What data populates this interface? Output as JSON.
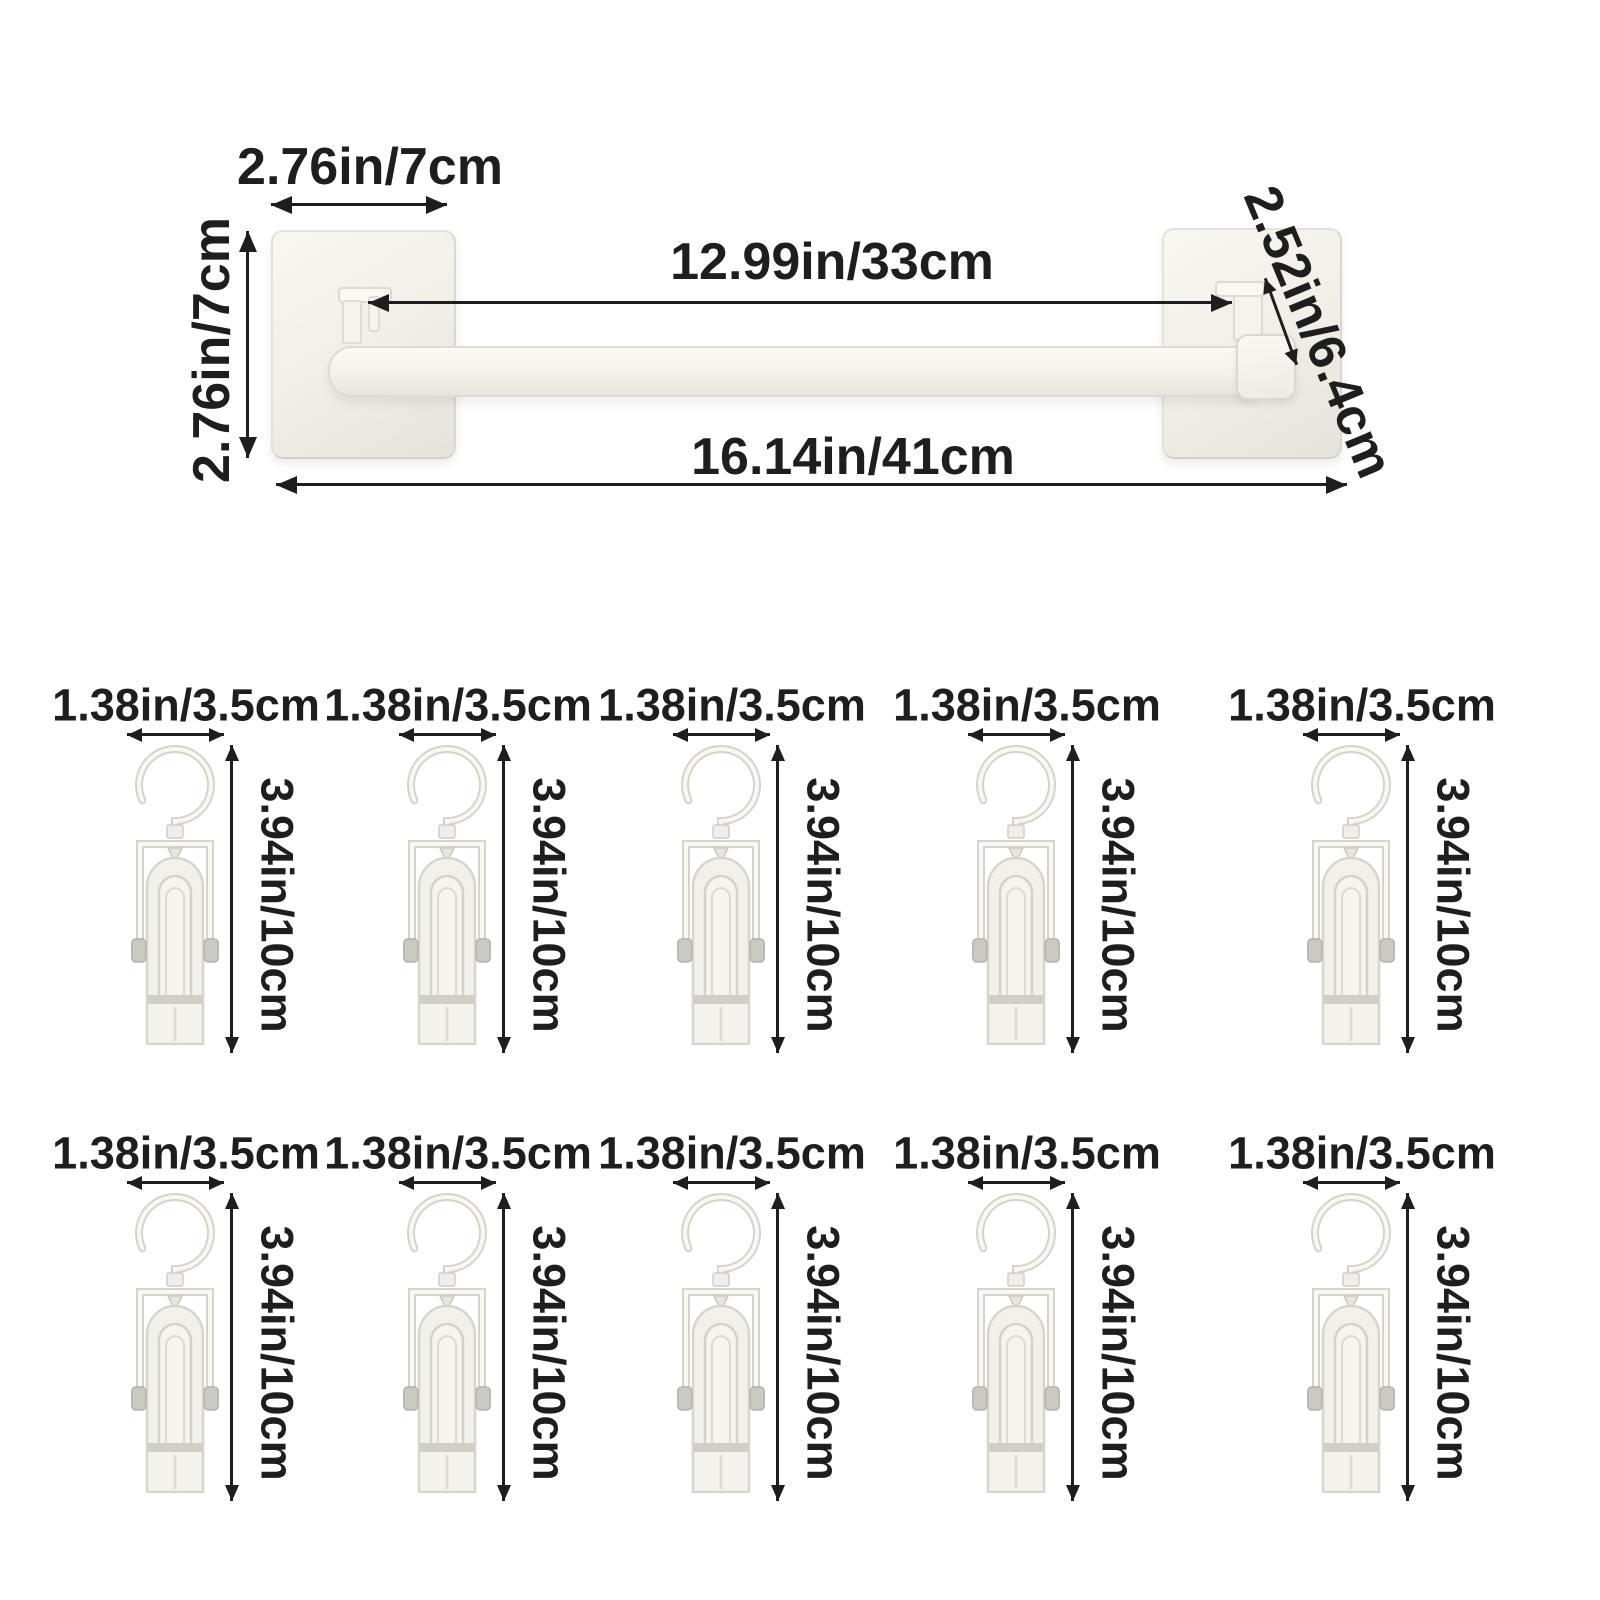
{
  "colors": {
    "ink": "#1e1e1e",
    "product_fill": "#f2f1eb",
    "product_outline": "#d9d8d0",
    "background": "#ffffff"
  },
  "rail": {
    "plate_width_label": "2.76in/7cm",
    "plate_height_label": "2.76in/7cm",
    "inner_span_label": "12.99in/33cm",
    "total_span_label": "16.14in/41cm",
    "hook_depth_label": "2.52in/6.4cm"
  },
  "clips": {
    "rows": [
      {
        "items": [
          {
            "width_label": "1.38in/3.5cm",
            "height_label": "3.94in/10cm"
          },
          {
            "width_label": "1.38in/3.5cm",
            "height_label": "3.94in/10cm"
          },
          {
            "width_label": "1.38in/3.5cm",
            "height_label": "3.94in/10cm"
          },
          {
            "width_label": "1.38in/3.5cm",
            "height_label": "3.94in/10cm"
          },
          {
            "width_label": "1.38in/3.5cm",
            "height_label": "3.94in/10cm"
          }
        ]
      },
      {
        "items": [
          {
            "width_label": "1.38in/3.5cm",
            "height_label": "3.94in/10cm"
          },
          {
            "width_label": "1.38in/3.5cm",
            "height_label": "3.94in/10cm"
          },
          {
            "width_label": "1.38in/3.5cm",
            "height_label": "3.94in/10cm"
          },
          {
            "width_label": "1.38in/3.5cm",
            "height_label": "3.94in/10cm"
          },
          {
            "width_label": "1.38in/3.5cm",
            "height_label": "3.94in/10cm"
          }
        ]
      }
    ]
  }
}
